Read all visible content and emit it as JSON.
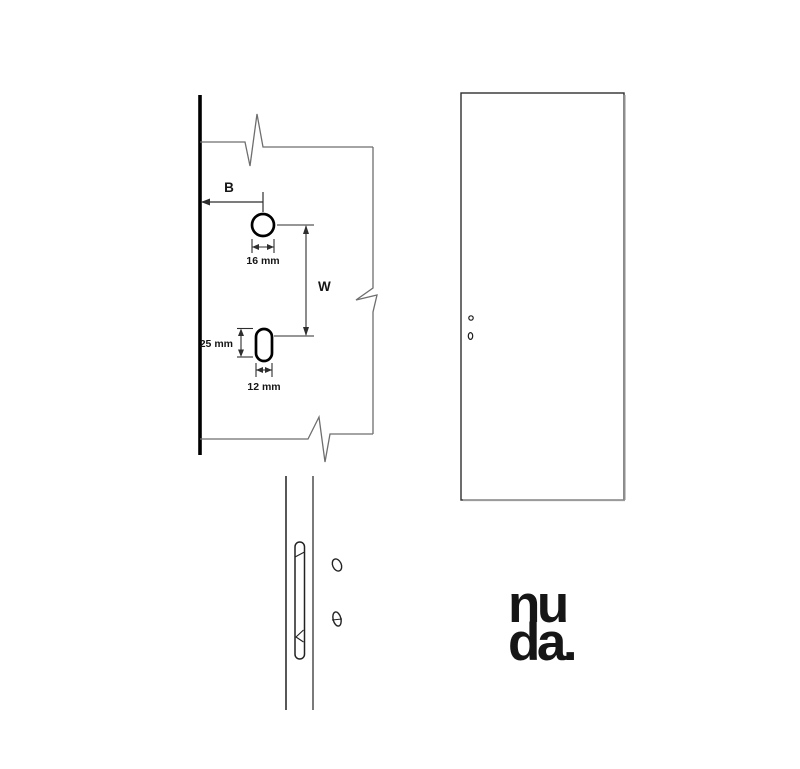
{
  "colors": {
    "ink": "#161616",
    "outline_gray": "#6e6e6e",
    "dimension_line": "#2e2e2e",
    "shadow_gray": "#8f8f8f",
    "background": "#ffffff"
  },
  "edge_view": {
    "dim_b_label": "B",
    "dim_w_label": "W",
    "circle_hole_diameter": "16 mm",
    "slot_height": "25 mm",
    "slot_width": "12 mm"
  },
  "logo": {
    "line1": "nu",
    "line2": "da."
  }
}
